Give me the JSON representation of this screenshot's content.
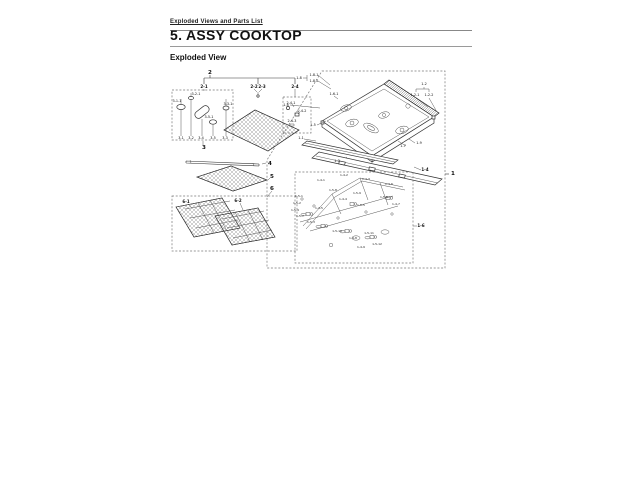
{
  "page": {
    "header": "Exploded Views and Parts List",
    "title": "5.  ASSY COOKTOP",
    "subtitle": "Exploded View"
  },
  "diagram": {
    "callouts": [
      {
        "t": "2",
        "x": 210,
        "y": 74,
        "s": "l"
      },
      {
        "t": "3",
        "x": 204,
        "y": 149,
        "s": "l"
      },
      {
        "t": "4",
        "x": 270,
        "y": 165,
        "s": "l"
      },
      {
        "t": "5",
        "x": 272,
        "y": 178,
        "s": "l"
      },
      {
        "t": "6",
        "x": 272,
        "y": 190,
        "s": "l"
      },
      {
        "t": "1",
        "x": 453,
        "y": 175,
        "s": "l"
      },
      {
        "t": "2-1",
        "x": 204,
        "y": 88,
        "s": "m"
      },
      {
        "t": "2-2",
        "x": 254,
        "y": 88,
        "s": "m"
      },
      {
        "t": "2-3",
        "x": 262,
        "y": 88,
        "s": "m"
      },
      {
        "t": "2-4",
        "x": 295,
        "y": 88,
        "s": "m"
      },
      {
        "t": "6-1",
        "x": 186,
        "y": 203,
        "s": "m"
      },
      {
        "t": "6-2",
        "x": 238,
        "y": 202,
        "s": "m"
      },
      {
        "t": "1-4",
        "x": 425,
        "y": 171,
        "s": "m"
      },
      {
        "t": "1-6",
        "x": 421,
        "y": 227,
        "s": "m"
      },
      {
        "t": "3-1",
        "x": 181,
        "y": 139,
        "s": "s"
      },
      {
        "t": "3-2",
        "x": 191,
        "y": 139,
        "s": "s"
      },
      {
        "t": "3-4",
        "x": 201,
        "y": 139,
        "s": "s"
      },
      {
        "t": "3-5",
        "x": 213,
        "y": 139,
        "s": "s"
      },
      {
        "t": "3-3",
        "x": 225,
        "y": 139,
        "s": "s"
      },
      {
        "t": "3-1-1",
        "x": 177,
        "y": 102,
        "s": "s"
      },
      {
        "t": "3-2-1",
        "x": 196,
        "y": 95,
        "s": "s"
      },
      {
        "t": "3-5-1",
        "x": 209,
        "y": 118,
        "s": "s"
      },
      {
        "t": "3-3-1",
        "x": 228,
        "y": 105,
        "s": "s"
      },
      {
        "t": "2-4-1",
        "x": 291,
        "y": 104,
        "s": "s"
      },
      {
        "t": "2-4-2",
        "x": 302,
        "y": 112,
        "s": "s"
      },
      {
        "t": "2-4-3",
        "x": 292,
        "y": 122,
        "s": "s"
      },
      {
        "t": "1-8",
        "x": 299,
        "y": 79,
        "s": "s"
      },
      {
        "t": "1-8-1",
        "x": 314,
        "y": 76,
        "s": "s"
      },
      {
        "t": "1-8-2",
        "x": 314,
        "y": 82,
        "s": "s"
      },
      {
        "t": "1-6",
        "x": 286,
        "y": 106,
        "s": "s"
      },
      {
        "t": "1-6-1",
        "x": 334,
        "y": 95,
        "s": "s"
      },
      {
        "t": "1-2",
        "x": 424,
        "y": 85,
        "s": "s"
      },
      {
        "t": "1-2-1",
        "x": 415,
        "y": 96,
        "s": "s"
      },
      {
        "t": "1-2-2",
        "x": 429,
        "y": 96,
        "s": "s"
      },
      {
        "t": "1-5",
        "x": 313,
        "y": 126,
        "s": "s"
      },
      {
        "t": "1-1",
        "x": 301,
        "y": 139,
        "s": "s"
      },
      {
        "t": "1-3",
        "x": 337,
        "y": 162,
        "s": "s"
      },
      {
        "t": "1-7",
        "x": 403,
        "y": 147,
        "s": "s"
      },
      {
        "t": "1-9",
        "x": 419,
        "y": 144,
        "s": "s"
      },
      {
        "t": "1-4-1",
        "x": 321,
        "y": 181,
        "s": "xs"
      },
      {
        "t": "1-4-2",
        "x": 344,
        "y": 176,
        "s": "xs"
      },
      {
        "t": "1-4-3",
        "x": 366,
        "y": 180,
        "s": "xs"
      },
      {
        "t": "1-4-6",
        "x": 389,
        "y": 185,
        "s": "xs"
      },
      {
        "t": "1-5-8",
        "x": 333,
        "y": 191,
        "s": "xs"
      },
      {
        "t": "1-5-9",
        "x": 357,
        "y": 194,
        "s": "xs"
      },
      {
        "t": "1-5-1",
        "x": 299,
        "y": 197,
        "s": "xs"
      },
      {
        "t": "1-5-2",
        "x": 297,
        "y": 204,
        "s": "xs"
      },
      {
        "t": "1-5-4",
        "x": 295,
        "y": 211,
        "s": "xs"
      },
      {
        "t": "1-5-7",
        "x": 300,
        "y": 217,
        "s": "xs"
      },
      {
        "t": "1-5-3",
        "x": 311,
        "y": 223,
        "s": "xs"
      },
      {
        "t": "1-4-5",
        "x": 319,
        "y": 209,
        "s": "xs"
      },
      {
        "t": "1-4-4",
        "x": 343,
        "y": 200,
        "s": "xs"
      },
      {
        "t": "1-5-5",
        "x": 361,
        "y": 206,
        "s": "xs"
      },
      {
        "t": "1-5-6",
        "x": 384,
        "y": 198,
        "s": "xs"
      },
      {
        "t": "1-4-7",
        "x": 396,
        "y": 205,
        "s": "xs"
      },
      {
        "t": "1-5-10",
        "x": 337,
        "y": 232,
        "s": "xs"
      },
      {
        "t": "1-4-8",
        "x": 353,
        "y": 239,
        "s": "xs"
      },
      {
        "t": "1-5-11",
        "x": 369,
        "y": 234,
        "s": "xs"
      },
      {
        "t": "1-4-9",
        "x": 361,
        "y": 248,
        "s": "xs"
      },
      {
        "t": "1-5-12",
        "x": 377,
        "y": 245,
        "s": "xs"
      }
    ]
  }
}
